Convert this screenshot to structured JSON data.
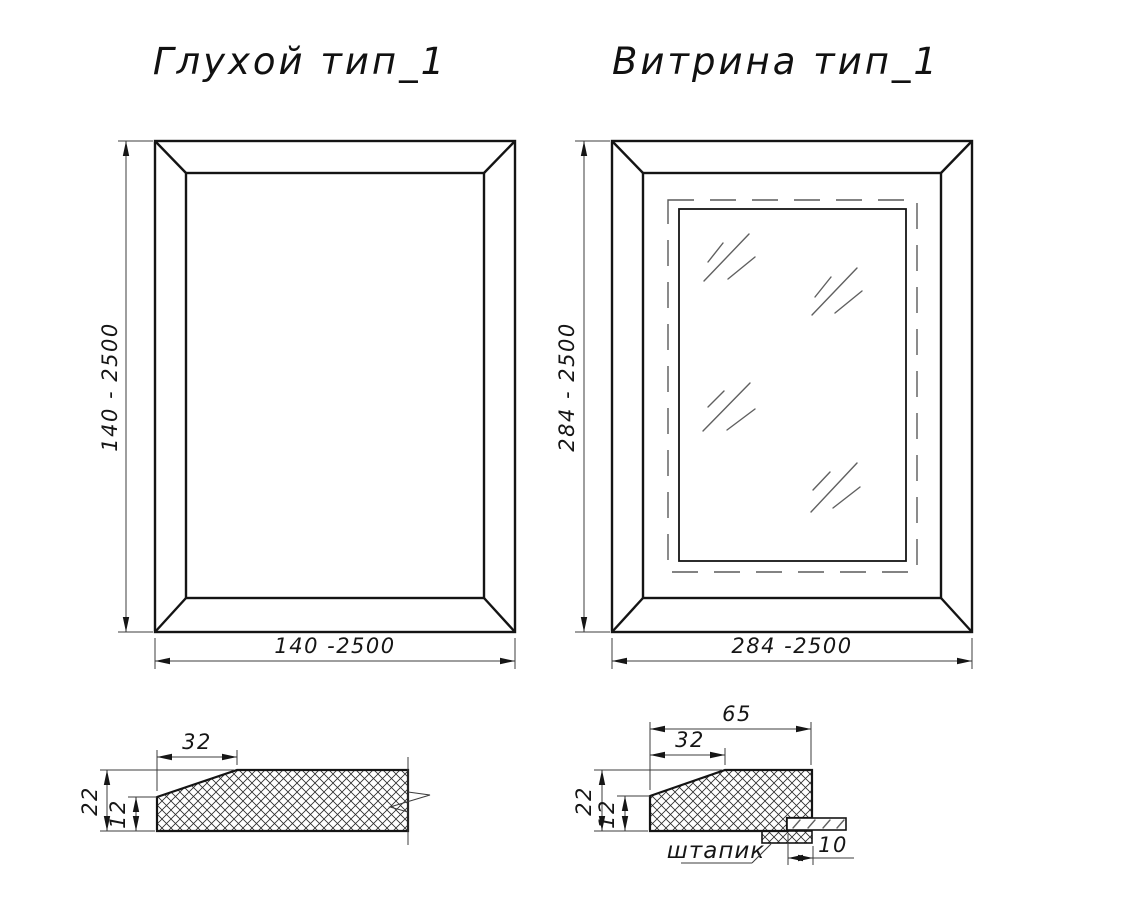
{
  "style": {
    "background": "#ffffff",
    "main_line_color": "#141414",
    "thin_line_color": "#3c3c3c",
    "glass_mark_color": "#606060"
  },
  "views": {
    "blind_front": {
      "title": "Глухой тип_1",
      "height_dim": "140 - 2500",
      "width_dim": "140 -2500"
    },
    "vitrine_front": {
      "title": "Витрина тип_1",
      "height_dim": "284 - 2500",
      "width_dim": "284 -2500"
    },
    "blind_section": {
      "top_width_dim": "32",
      "thickness_dim": "22",
      "edge_thickness_dim": "12"
    },
    "vitrine_section": {
      "total_width_dim": "65",
      "top_width_dim": "32",
      "thickness_dim": "22",
      "edge_thickness_dim": "12",
      "glazing_depth_dim": "10",
      "bead_label": "штапик"
    }
  }
}
